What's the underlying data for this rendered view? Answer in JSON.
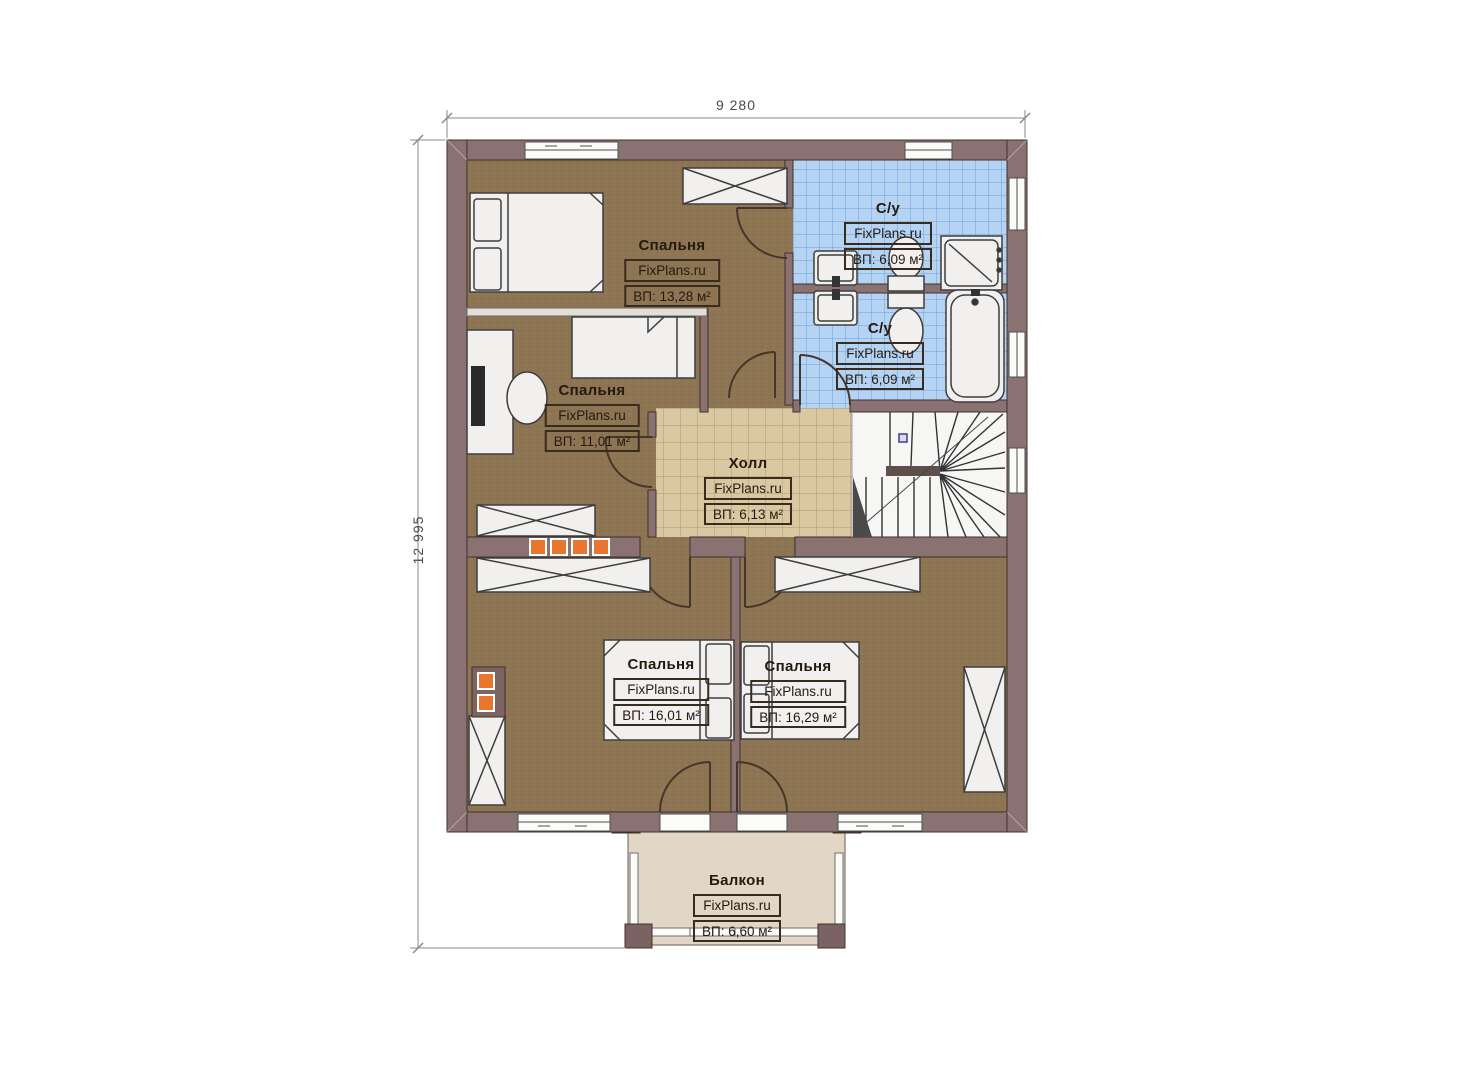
{
  "plan": {
    "dimension_width": "9 280",
    "dimension_height": "12 995",
    "watermark": "FixPlans.ru",
    "rooms": [
      {
        "id": "bedroom-top-left",
        "name": "Спальня",
        "area": "ВП: 13,28 м²"
      },
      {
        "id": "bathroom-top",
        "name": "С/у",
        "area": "ВП: 6,09 м²"
      },
      {
        "id": "bathroom-bottom",
        "name": "С/у",
        "area": "ВП: 6,09 м²"
      },
      {
        "id": "bedroom-mid-left",
        "name": "Спальня",
        "area": "ВП: 11,01 м²"
      },
      {
        "id": "hall",
        "name": "Холл",
        "area": "ВП: 6,13 м²"
      },
      {
        "id": "bedroom-bottom-left",
        "name": "Спальня",
        "area": "ВП: 16,01 м²"
      },
      {
        "id": "bedroom-bottom-right",
        "name": "Спальня",
        "area": "ВП: 16,29 м²"
      },
      {
        "id": "balcony",
        "name": "Балкон",
        "area": "ВП: 6,60 м²"
      }
    ],
    "colors": {
      "wall": "#8a7272",
      "wall_outline": "#40302a",
      "bedroom_floor": "#8d7554",
      "bathroom_floor": "#b5d4f4",
      "bathroom_grid": "#6e9ed6",
      "hall_floor": "#d9c8a2",
      "hall_grid": "#ae9a6f",
      "balcony_floor": "#e2d6c4",
      "furniture": "#f1f0ee",
      "accent_orange": "#e8762e",
      "dimension_line": "#8a8a8a"
    }
  }
}
